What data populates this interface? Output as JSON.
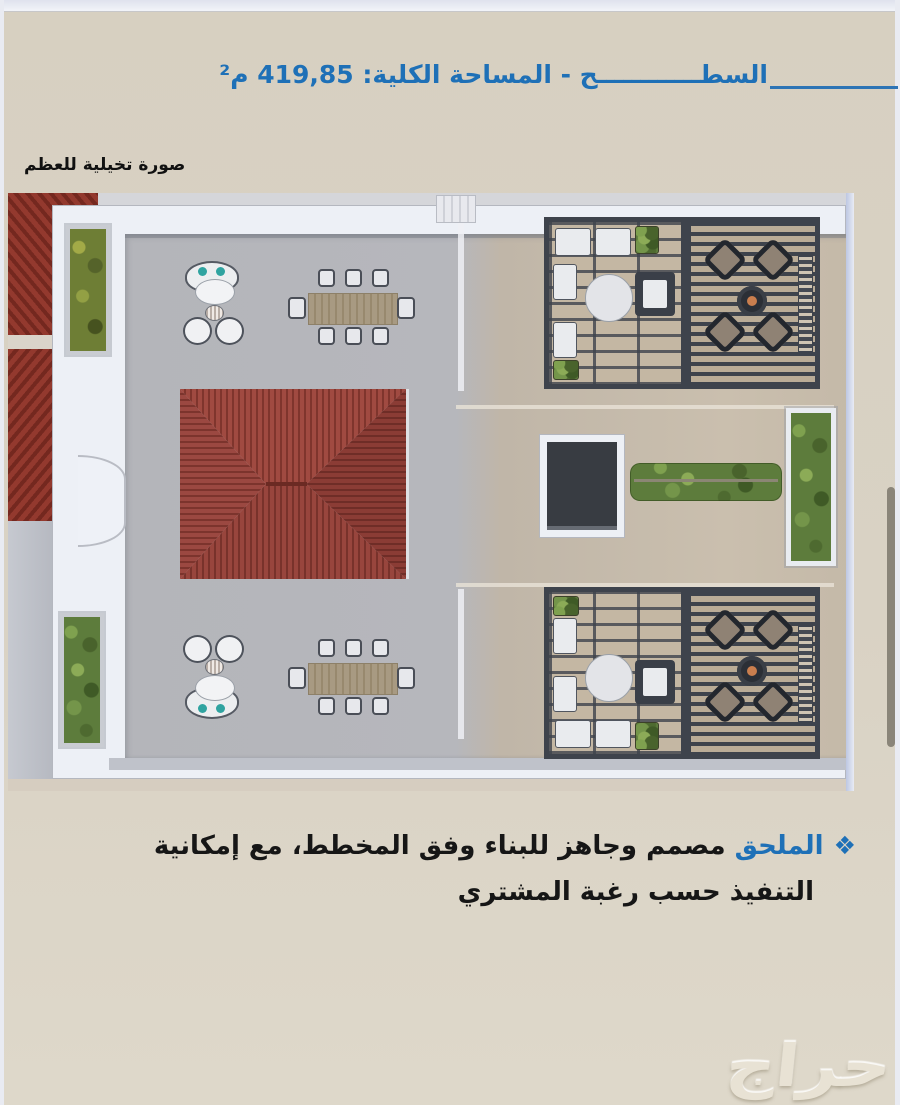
{
  "header": {
    "title": "السطــــــــــــح - المساحة الكلية: 419,85 م²",
    "accent_color": "#1e70b7"
  },
  "render": {
    "caption": "صورة تخيلية للعظم",
    "type": "3d-rooftop-floorplan-render",
    "features": [
      "red hip-roof structure",
      "two 8-seat outdoor dining tables",
      "two round lounge seating groups with teal cushions",
      "two grid pergolas with white sofas",
      "two slatted pergolas with x-shaped lounge chairs",
      "stairwell opening",
      "hedge row and green planters",
      "arched wall niche"
    ]
  },
  "note": {
    "bullet_icon": "❖",
    "lead": "الملحق",
    "body": "مصمم وجاهز للبناء وفق المخطط، مع إمكانية التنفيذ حسب رغبة المشتري"
  },
  "watermark": {
    "text": "حراج"
  },
  "colors": {
    "page_bg": "#d9d2c4",
    "accent_blue": "#1e70b7",
    "roof_red": "#9c4439",
    "pergola_slate": "#3e434c",
    "plant_green": "#5d7c3c",
    "floor_grey": "#b6b7bc",
    "floor_tan": "#cabfae",
    "watermark": "#e8e2d4",
    "scrollbar_thumb": "#8a8579"
  }
}
